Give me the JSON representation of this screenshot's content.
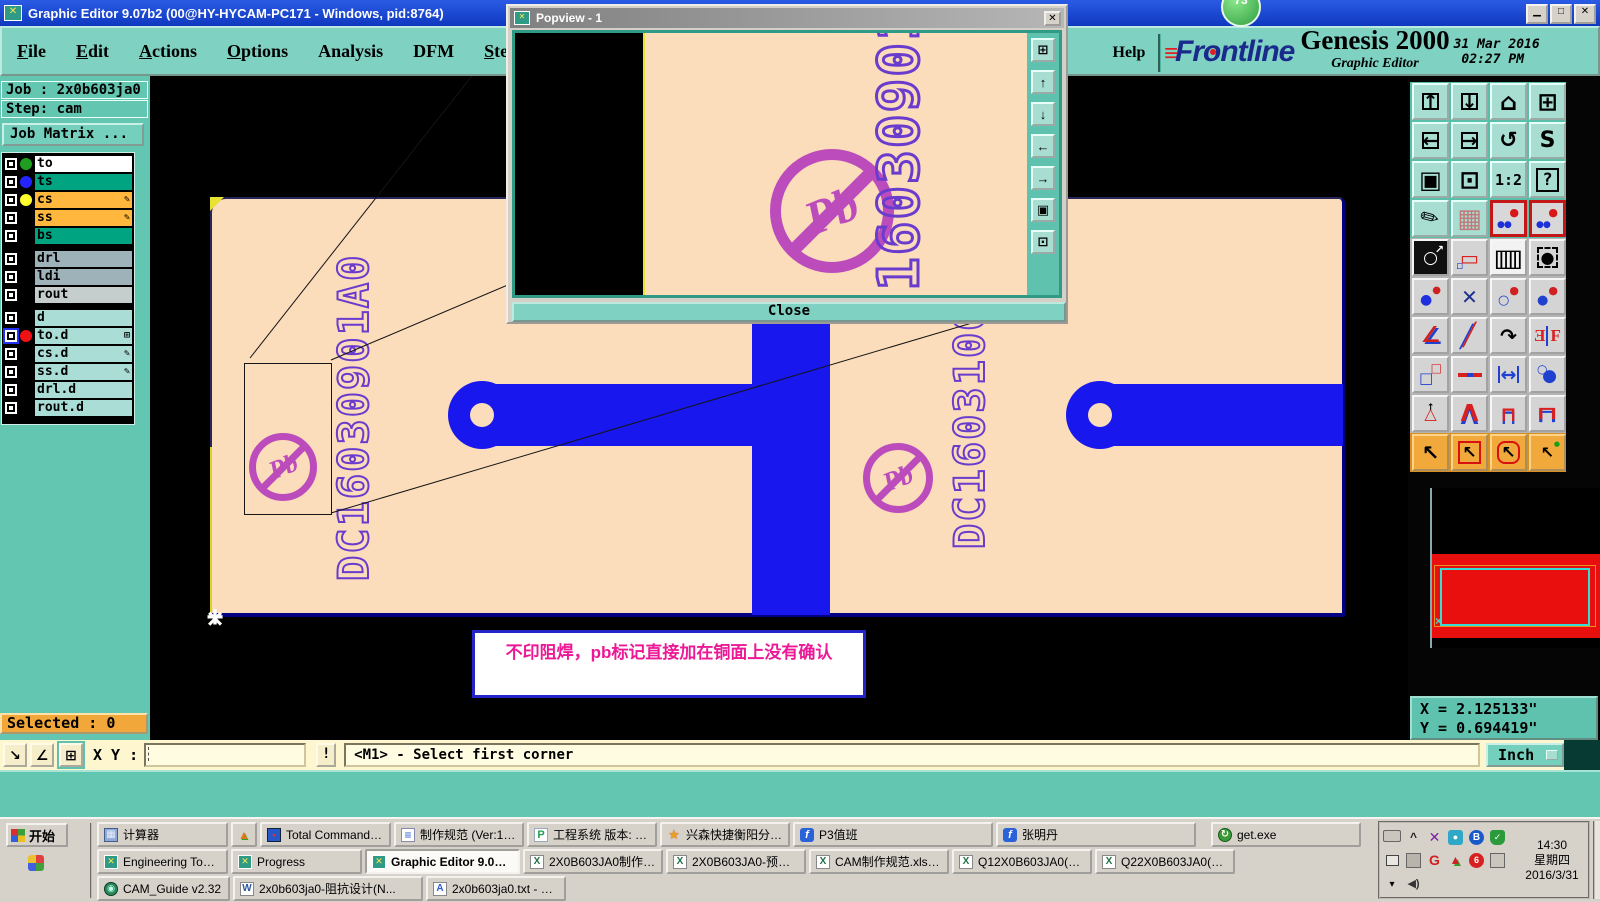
{
  "window": {
    "title": "Graphic Editor 9.07b2 (00@HY-HYCAM-PC171 - Windows, pid:8764)",
    "badge": "73"
  },
  "menu": {
    "items": [
      "File",
      "Edit",
      "Actions",
      "Options",
      "Analysis",
      "DFM",
      "Step",
      "Rout",
      "Windows"
    ],
    "help": "Help"
  },
  "brand": {
    "name": "Frontline",
    "product": "Genesis 2000",
    "subtitle": "Graphic Editor",
    "datetime": "31 Mar 2016\n 02:27 PM"
  },
  "job_panel": {
    "job": "Job : 2x0b603ja0",
    "step": "Step: cam",
    "matrix_button": "Job Matrix ..."
  },
  "layers": {
    "group1": [
      {
        "name": "to",
        "bg": "#ffffff",
        "dot": "#1f9e1f"
      },
      {
        "name": "ts",
        "bg": "#00a480",
        "dot": "#2424ff"
      },
      {
        "name": "cs",
        "bg": "#ffb83d",
        "dot": "#ffff2e",
        "mark": "✎"
      },
      {
        "name": "ss",
        "bg": "#ffb83d",
        "mark": "✎"
      },
      {
        "name": "bs",
        "bg": "#00a480"
      }
    ],
    "group2": [
      {
        "name": "drl",
        "bg": "#9eb2ba"
      },
      {
        "name": "ldi",
        "bg": "#9eb2ba"
      },
      {
        "name": "rout",
        "bg": "#c6cdcd"
      }
    ],
    "group3": [
      {
        "name": "d",
        "bg": "#aaddd6"
      },
      {
        "name": "to.d",
        "bg": "#aaddd6",
        "dot": "#ee1212",
        "mark": "⊞",
        "active": true
      },
      {
        "name": "cs.d",
        "bg": "#aaddd6",
        "mark": "✎"
      },
      {
        "name": "ss.d",
        "bg": "#aaddd6",
        "mark": "✎"
      },
      {
        "name": "drl.d",
        "bg": "#aaddd6"
      },
      {
        "name": "rout.d",
        "bg": "#aaddd6"
      }
    ]
  },
  "popview": {
    "title": "Popview - 1",
    "close_button": "Close",
    "board_text": "16030901A0"
  },
  "board": {
    "text_left": "DC16030901A0",
    "text_mid": "DC16031001A0",
    "pb_label": "Pb",
    "note": "不印阻焊，pb标记直接加在铜面上没有确认",
    "copper_color": "#1717ee",
    "mask_color": "#fbdcbb",
    "mark_color": "#bc4cbc"
  },
  "status": {
    "selected": "Selected : 0",
    "xy_label": "X Y :",
    "xy_value": "",
    "alert": "!",
    "prompt": "<M1> - Select first corner",
    "unit": "Inch"
  },
  "readout": {
    "x": "X = 2.125133\"",
    "y": "Y = 0.694419\""
  },
  "toolbar": {
    "ratio": "1:2",
    "query": "?"
  },
  "taskbar": {
    "start": "开始",
    "row1": [
      {
        "label": "计算器"
      },
      {
        "label": "Total Commander 7.0 ..."
      },
      {
        "label": "制作规范 (Ver:1.0.6)"
      },
      {
        "label": "工程系统  版本: 1.1..."
      },
      {
        "label": "兴森快捷衡阳分公司..."
      },
      {
        "label": "P3值班"
      },
      {
        "label": "张明丹"
      },
      {
        "label": "get.exe"
      }
    ],
    "row2": [
      {
        "label": "Engineering Toolkit 9.07..."
      },
      {
        "label": "Progress"
      },
      {
        "label": "Graphic Editor 9.07b..."
      },
      {
        "label": "2X0B603JA0制作单.xls ..."
      },
      {
        "label": "2X0B603JA0-预审指示...."
      },
      {
        "label": "CAM制作规范.xls [兼..."
      },
      {
        "label": "Q12X0B603JA0(P6Ys)2..."
      },
      {
        "label": "Q22X0B603JA0(P6Ys)2..."
      }
    ],
    "row3": [
      {
        "label": "CAM_Guide v2.32"
      },
      {
        "label": "2x0b603ja0-阻抗设计(N..."
      },
      {
        "label": "2x0b603ja0.txt - 写字板"
      }
    ],
    "tray": {
      "time": "14:30",
      "day": "星期四",
      "date": "2016/3/31"
    }
  }
}
